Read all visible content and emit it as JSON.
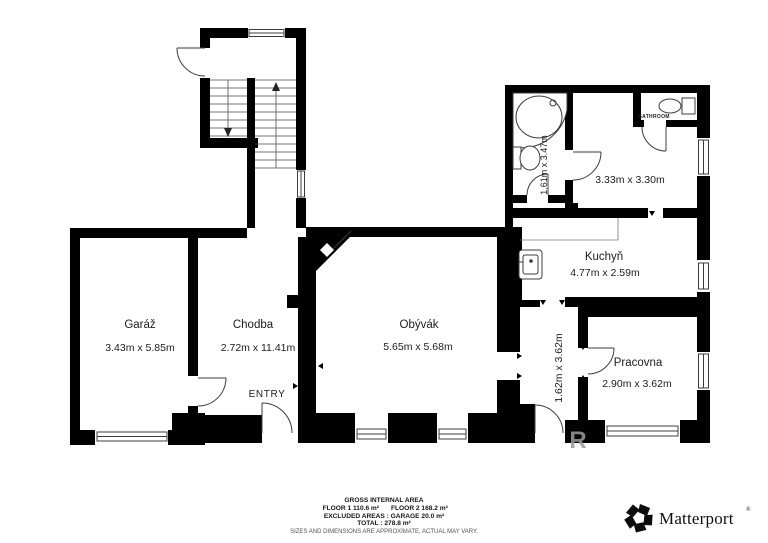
{
  "plan": {
    "rooms": {
      "garaz": {
        "name": "Garáž",
        "dims": "3.43m x 5.85m"
      },
      "chodba": {
        "name": "Chodba",
        "dims": "2.72m x 11.41m"
      },
      "obyvak": {
        "name": "Obývák",
        "dims": "5.65m x 5.68m"
      },
      "kuchyn": {
        "name": "Kuchyň",
        "dims": "4.77m x 2.59m"
      },
      "pracovna": {
        "name": "Pracovna",
        "dims": "2.90m x 3.62m"
      },
      "bathroom": {
        "name": "BATHROOM",
        "dims": "3.33m x 3.30m"
      },
      "bath_hall": {
        "dims": "1.61m x 3.47m"
      },
      "corridor": {
        "dims": "1.62m x 3.62m"
      }
    },
    "entry_label": "ENTRY",
    "watermark": "R"
  },
  "footer": {
    "title": "GROSS INTERNAL AREA",
    "floor1": "FLOOR 1 110.6 m²",
    "floor2": "FLOOR 2 168.2 m²",
    "excluded": "EXCLUDED AREAS :  GARAGE 20.0 m²",
    "total": "TOTAL :  278.8 m²",
    "disclaimer": "SIZES AND DIMENSIONS ARE APPROXIMATE, ACTUAL MAY VARY."
  },
  "branding": {
    "name": "Matterport",
    "mark": "®"
  },
  "colors": {
    "wall": "#000000",
    "background": "#ffffff",
    "line": "#3c3c3c",
    "watermark": "#9a9a9a"
  }
}
